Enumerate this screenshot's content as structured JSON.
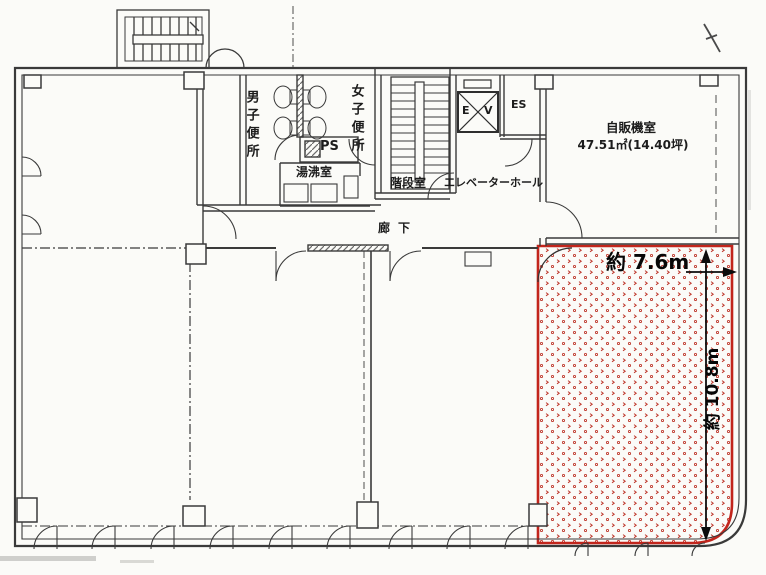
{
  "rooms": {
    "mens_toilet": "男子便所",
    "womens_toilet": "女子便所",
    "pipe_shaft": "PS",
    "hot_water_room": "湯沸室",
    "stairwell": "階段室",
    "elevator_hall": "エレベーターホール",
    "elevator_shaft_left": "E",
    "elevator_shaft_right": "V",
    "es_shaft": "ES",
    "vending_machine_room": "自販機室",
    "vending_machine_room_area": "47.51㎡(14.40坪)",
    "corridor": "廊下"
  },
  "highlighted_area": {
    "width_label": "約 7.6m",
    "height_label": "約 10.8m",
    "border_color": "#c2251c",
    "dot_color": "#bf3a2e"
  },
  "drawing": {
    "wall_color": "#3a3a3a",
    "paper_color": "#fbfbf8"
  }
}
